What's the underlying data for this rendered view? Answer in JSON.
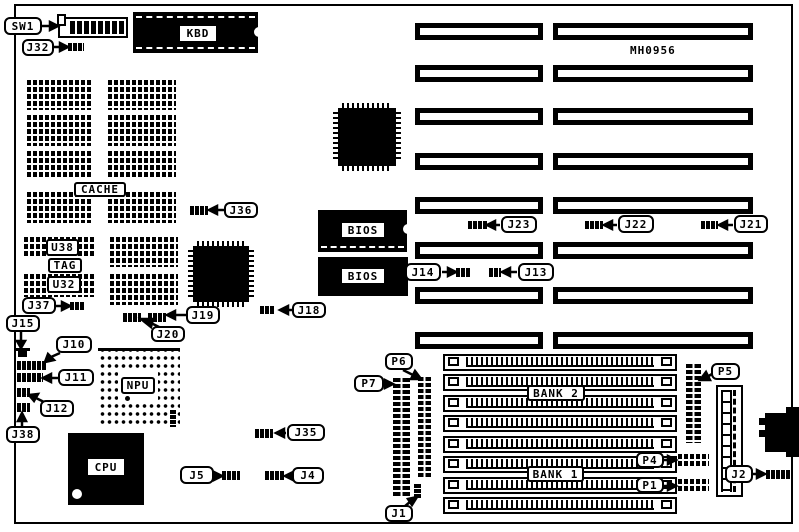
{
  "board": {
    "part_number": "MH0956"
  },
  "colors": {
    "ink": "#000000",
    "paper": "#ffffff"
  },
  "callouts": {
    "sw1": "SW1",
    "j32": "J32",
    "kbd": "KBD",
    "cache": "CACHE",
    "u38": "U38",
    "tag": "TAG",
    "u32": "U32",
    "j36": "J36",
    "j37": "J37",
    "j15": "J15",
    "j10": "J10",
    "j11": "J11",
    "j12": "J12",
    "j38": "J38",
    "npu": "NPU",
    "cpu": "CPU",
    "j5": "J5",
    "j4": "J4",
    "j35": "J35",
    "j19": "J19",
    "j20": "J20",
    "j18": "J18",
    "bios": "BIOS",
    "j23": "J23",
    "j22": "J22",
    "j21": "J21",
    "j14": "J14",
    "j13": "J13",
    "bank2": "BANK 2",
    "bank1": "BANK 1",
    "p7": "P7",
    "p6": "P6",
    "p5": "P5",
    "p4": "P4",
    "p1": "P1",
    "j2": "J2",
    "j1": "J1"
  }
}
